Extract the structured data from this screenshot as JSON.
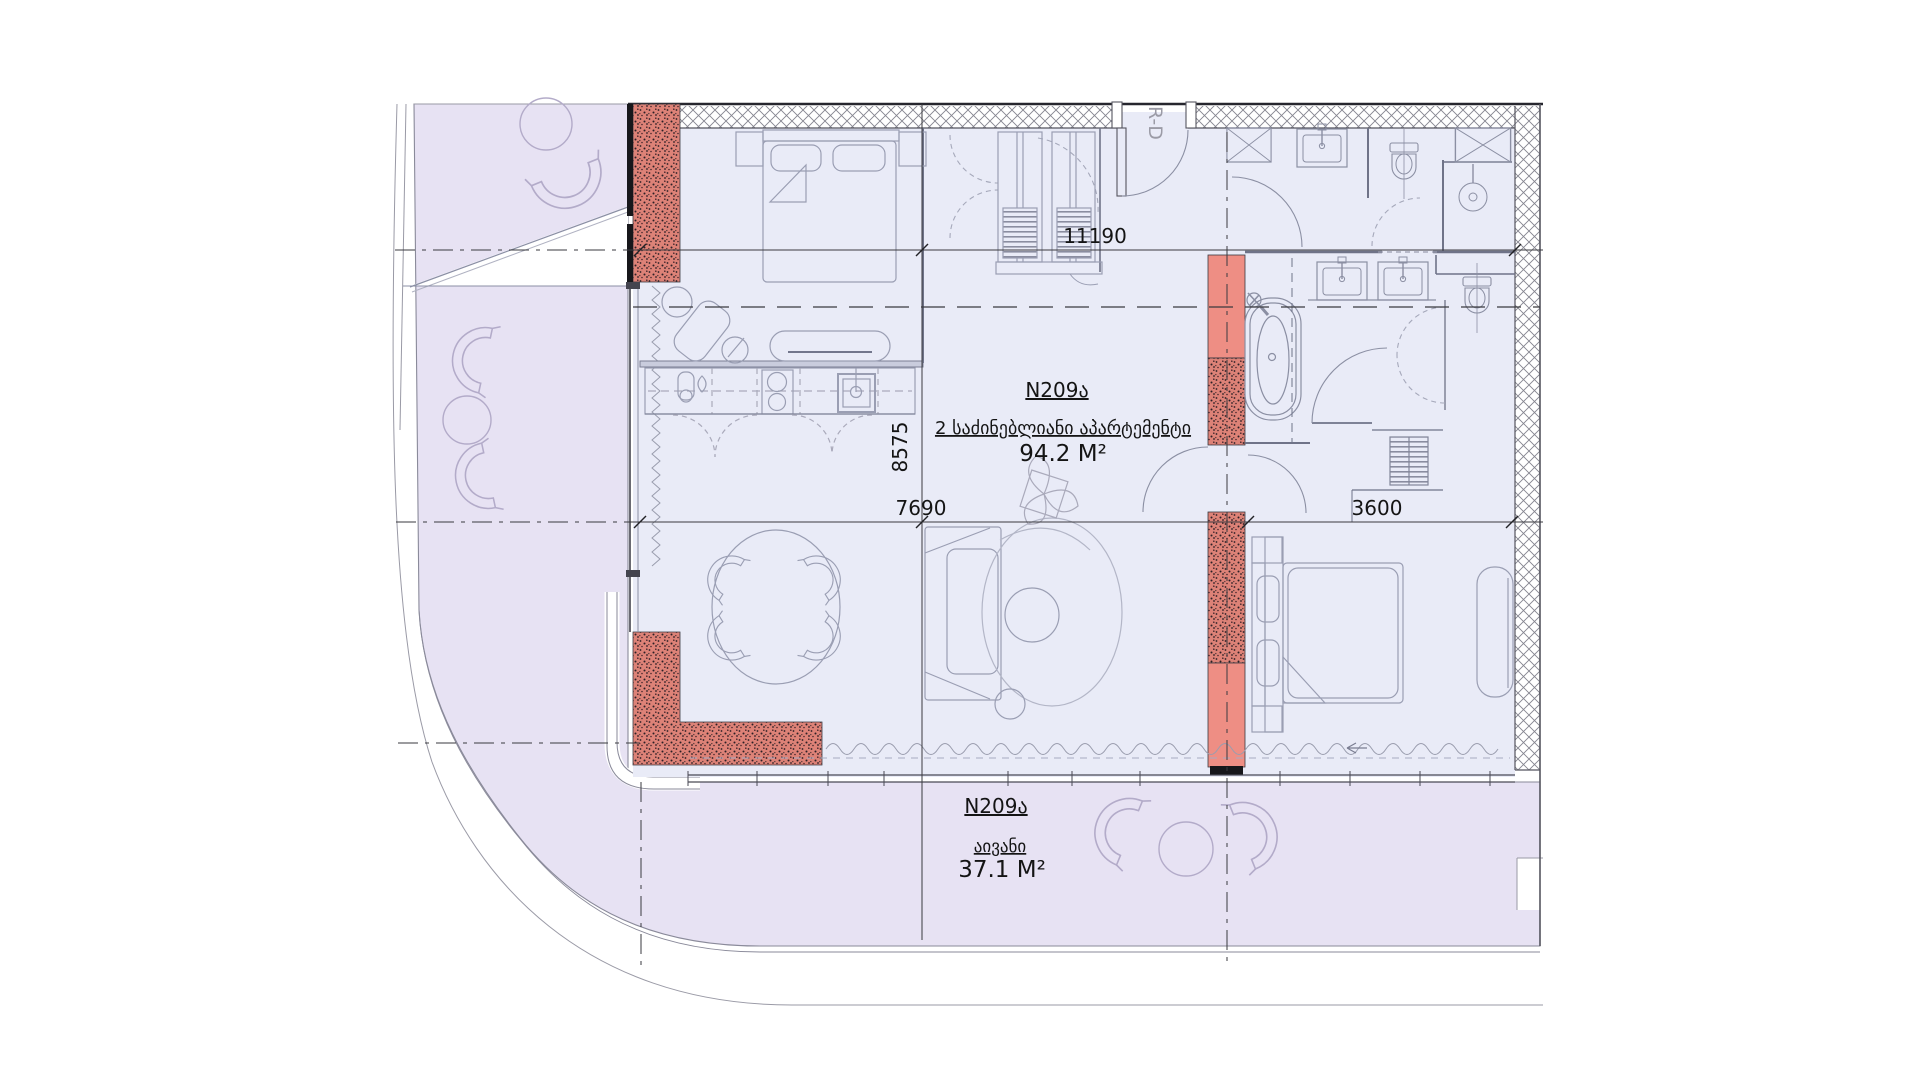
{
  "floor_plan": {
    "apartment": {
      "unit": "N209ა",
      "type_label": "2 საძინებლიანი აპარტემენტი",
      "area": "94.2 M²"
    },
    "balcony": {
      "unit": "N209ა",
      "name_label": "აივანი",
      "area": "37.1 M²"
    },
    "dimensions": {
      "width_top": "11190",
      "height_left": "8575",
      "width_living": "7690",
      "width_bedroom": "3600"
    },
    "entrance_label": "R-D",
    "colors": {
      "balcony_fill": "#e7e2f3",
      "floor_fill": "#e9ebf7",
      "wall_red_solid": "#ee8e84",
      "wall_red_hatch": "#dd8277",
      "wall_dark": "#26262e",
      "line_gray": "#8b8fa3",
      "grid_line": "#3a3a3f"
    }
  }
}
